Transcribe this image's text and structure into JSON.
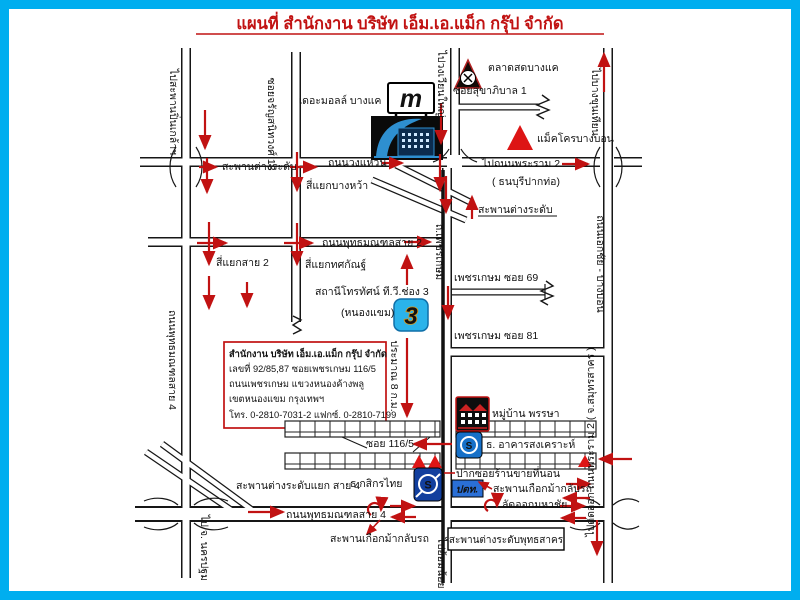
{
  "title": "แผนที่ สำนักงาน  บริษัท เอ็ม.เอ.แม็ก กรุ๊ป จำกัด",
  "colors": {
    "frame": "#00aeef",
    "red": "#c11212",
    "logo_blue": "#1777c4"
  },
  "roads": {
    "v1_top": "ไปสะพานปิ่นเกล้าฯ",
    "v1_mid": "ถนนพุทธมณฑลสาย 4",
    "v1_bottom": "ไป จ. นครปฐม",
    "v2": "ซอยจรัญสนิทวงศ์ 13",
    "v3_top": "ไปวงเวียนใหญ่",
    "v4": "ถ.เพชรเกษม",
    "v4_bottom": "ไปอ้อมน้อย",
    "v5_top": "ไปบางขุนเทียน",
    "v5_mid": "ถนนเอกชัย - บางบอน",
    "v5_bottom": "ไปตัดออก ถนนพระราม 2 ( จ.สมุทรสาคร )",
    "h1": "ถนนวงแหวน",
    "h1_right": "ไปถนนพระราม 2",
    "h1_right_sub": "( ธนบุรีปากท่อ)",
    "h2": "ถนนพุทธมณฑลสาย 2",
    "h4": "ถนนพุทธมณฑลสาย 4",
    "soi_sukhaphiban": "ซอยสุขาภิบาล 1",
    "soi69": "เพชรเกษม ซอย 69",
    "soi81": "เพชรเกษม ซอย 81",
    "soi1165": "ซอย 116/5"
  },
  "junctions": {
    "interchange_left": "สะพานต่างระดับ",
    "interchange_phet": "สะพานต่างระดับ",
    "bangwa": "สี่แยกบางหว้า",
    "sai2": "สี่แยกสาย 2",
    "totsakan": "สี่แยกทศกัณฐ์",
    "sai4_interchange": "สะพานต่างระดับแยก สาย 4",
    "horseshoe1": "สะพานเกือกม้ากลับรถ",
    "horseshoe2": "สะพานเกือกม้ากลับรถ",
    "mahachai": "ลัดออกมหาชัย",
    "phutthasakhon": "สะพานต่างระดับพุทธสาคร"
  },
  "places": {
    "mall": "เดอะมอลล์ บางแค",
    "market": "ตลาดสดบางแค",
    "makro": "แม็คโครบางบอน",
    "ch3_1": "สถานีโทรทัศน์ ที.วี.ช่อง 3",
    "ch3_2": "(หนองแขม)",
    "village": "หมู่บ้าน พรรษา",
    "ghb": "ธ. อาคารสงเคราะห์",
    "kbank": "ธ.กสิกรไทย",
    "ptt": "ปตท.",
    "mattress": "ปากซอยร้านขายที่นอน"
  },
  "office": {
    "line1": "สำนักงาน  บริษัท เอ็ม.เอ.แม็ก กรุ๊ป จำกัด",
    "line2": "เลขที่ 92/85,87  ซอยเพชรเกษม 116/5",
    "line3": "ถนนเพชรเกษม  แขวงหนองค้างพลู",
    "line4": "เขตหนองแขม  กรุงเทพฯ",
    "line5": "โทร. 0-2810-7031-2  แฟกซ์. 0-2810-7199"
  },
  "annotations": {
    "approx": "ประมาณ 8 ก.ม."
  },
  "logos": {
    "mall": "m",
    "ch3": "3",
    "kbank": "S",
    "ghb": "S"
  }
}
